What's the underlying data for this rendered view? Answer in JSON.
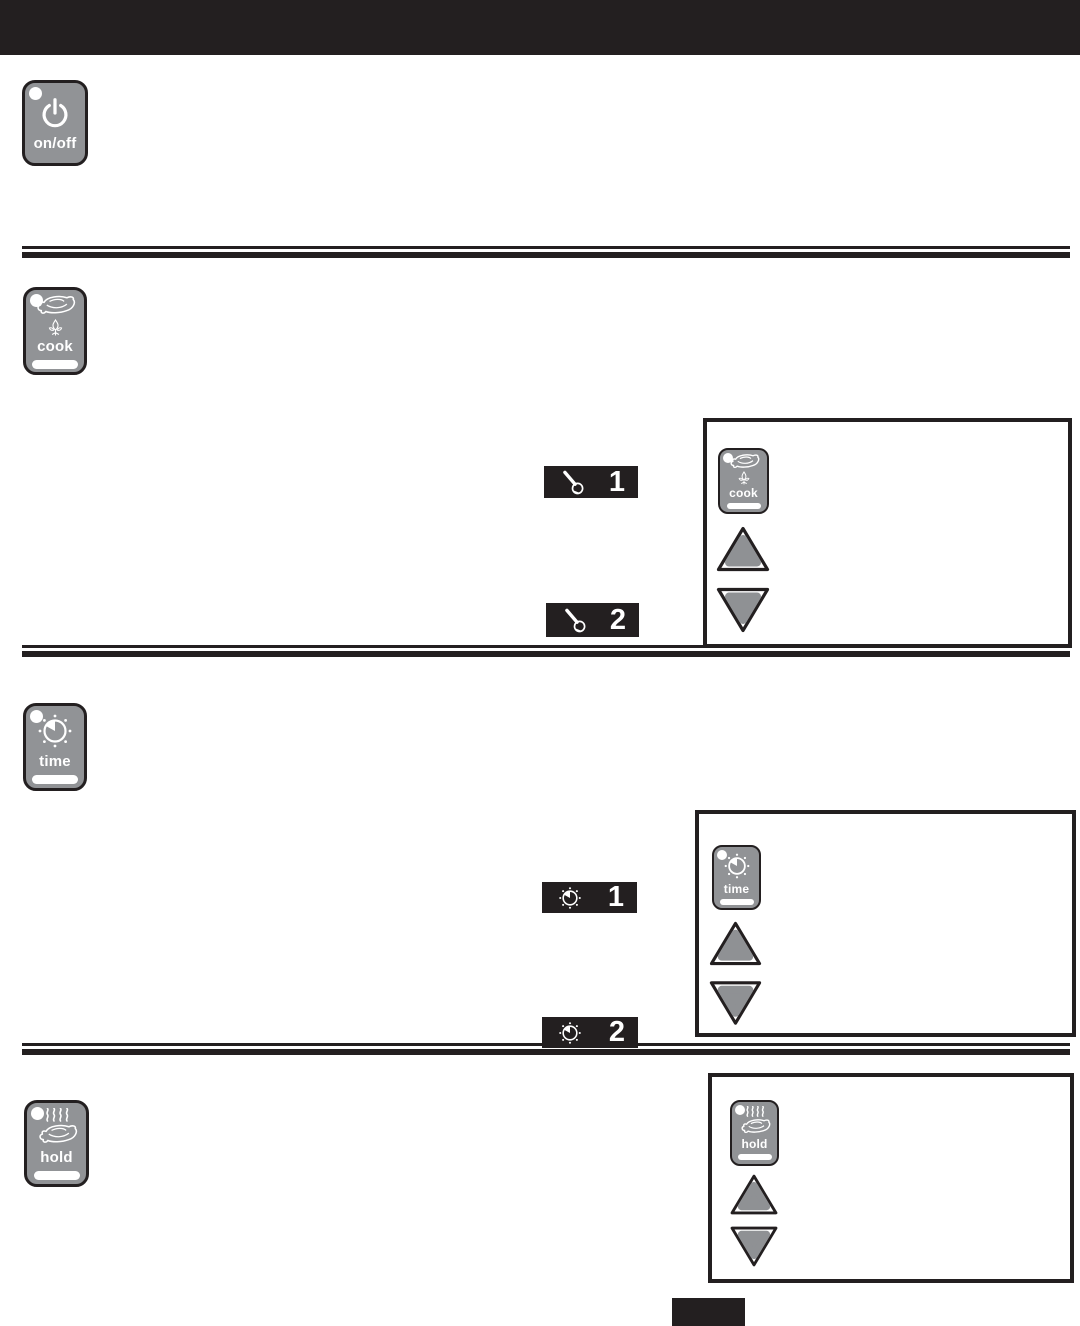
{
  "colors": {
    "ink": "#231f20",
    "key_gray": "#919396",
    "arrow_gray": "#8f9194",
    "white": "#ffffff"
  },
  "buttons": {
    "onoff": {
      "label": "on/off",
      "icon": "power-icon"
    },
    "cook": {
      "label": "cook",
      "icon": "turkey-flame-icon"
    },
    "time": {
      "label": "time",
      "icon": "timer-dial-icon"
    },
    "hold": {
      "label": "hold",
      "icon": "turkey-steam-icon"
    }
  },
  "steps": {
    "cook": [
      {
        "icon": "meat-thermometer-icon",
        "number": "1"
      },
      {
        "icon": "meat-thermometer-icon",
        "number": "2"
      }
    ],
    "time": [
      {
        "icon": "timer-dial-icon",
        "number": "1"
      },
      {
        "icon": "timer-dial-icon",
        "number": "2"
      }
    ]
  },
  "panels": {
    "cook": {
      "button_label": "cook",
      "arrows": [
        "up",
        "down"
      ]
    },
    "time": {
      "button_label": "time",
      "arrows": [
        "up",
        "down"
      ]
    },
    "hold": {
      "button_label": "hold",
      "arrows": [
        "up",
        "down"
      ]
    }
  }
}
